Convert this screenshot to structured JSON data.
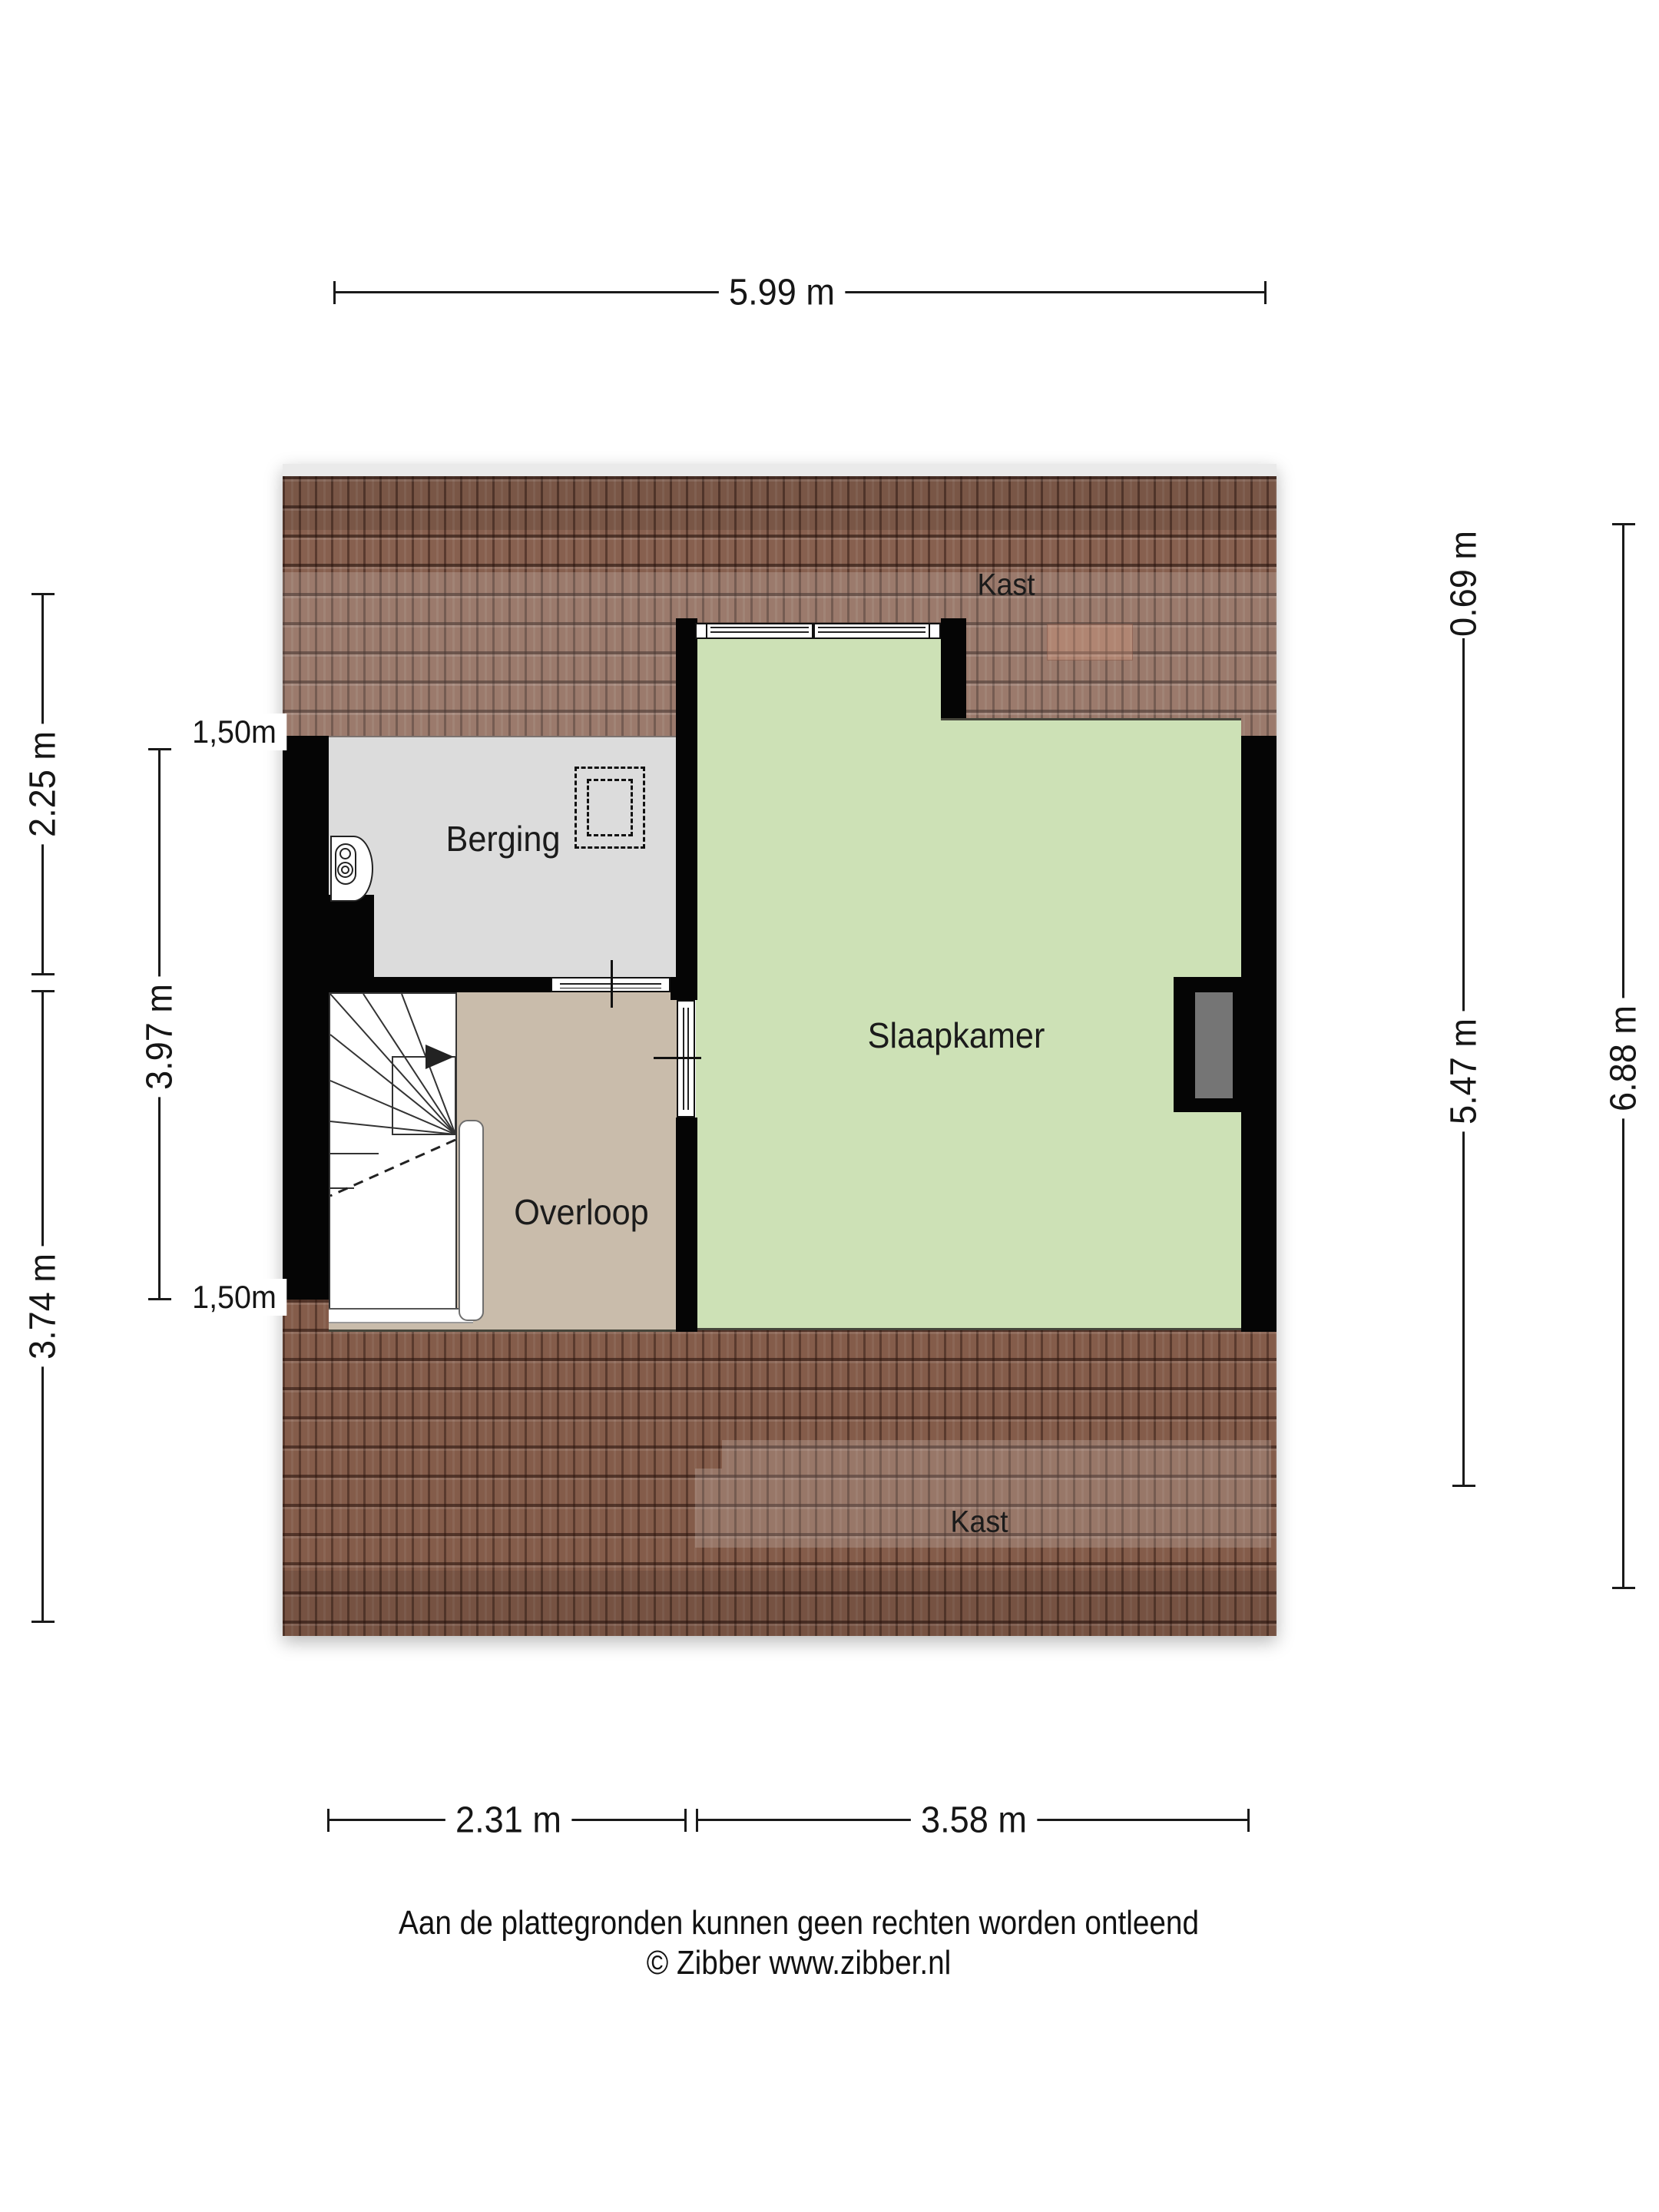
{
  "plan_type": "floorplan-attic",
  "rooms": {
    "berging": {
      "label": "Berging"
    },
    "slaapkamer": {
      "label": "Slaapkamer"
    },
    "overloop": {
      "label": "Overloop"
    },
    "kast_top": {
      "label": "Kast"
    },
    "kast_bottom": {
      "label": "Kast"
    }
  },
  "dimensions": {
    "top_width": {
      "label": "5.99 m",
      "orientation": "horizontal"
    },
    "bottom_left_width": {
      "label": "2.31 m",
      "orientation": "horizontal"
    },
    "bottom_right_width": {
      "label": "3.58 m",
      "orientation": "horizontal"
    },
    "left_outer_upper": {
      "label": "2.25 m",
      "orientation": "vertical"
    },
    "left_outer_lower": {
      "label": "3.74 m",
      "orientation": "vertical"
    },
    "left_inner": {
      "label": "3.97 m",
      "orientation": "vertical"
    },
    "headroom_top": {
      "label": "1,50m",
      "orientation": "horizontal"
    },
    "headroom_bottom": {
      "label": "1,50m",
      "orientation": "horizontal"
    },
    "right_inner_upper": {
      "label": "0.69 m",
      "orientation": "vertical"
    },
    "right_inner_lower": {
      "label": "5.47 m",
      "orientation": "vertical"
    },
    "right_outer": {
      "label": "6.88 m",
      "orientation": "vertical"
    }
  },
  "footer": {
    "line1": "Aan de plattegronden kunnen geen rechten worden ontleend",
    "line2": "© Zibber www.zibber.nl"
  },
  "colors": {
    "roof_tile": "#87604f",
    "berging_floor": "#dcdcdc",
    "slaapkamer_floor": "#cde1b6",
    "overloop_floor": "#c9bcab",
    "wall": "#050505",
    "dormer_panel": "#757575"
  }
}
